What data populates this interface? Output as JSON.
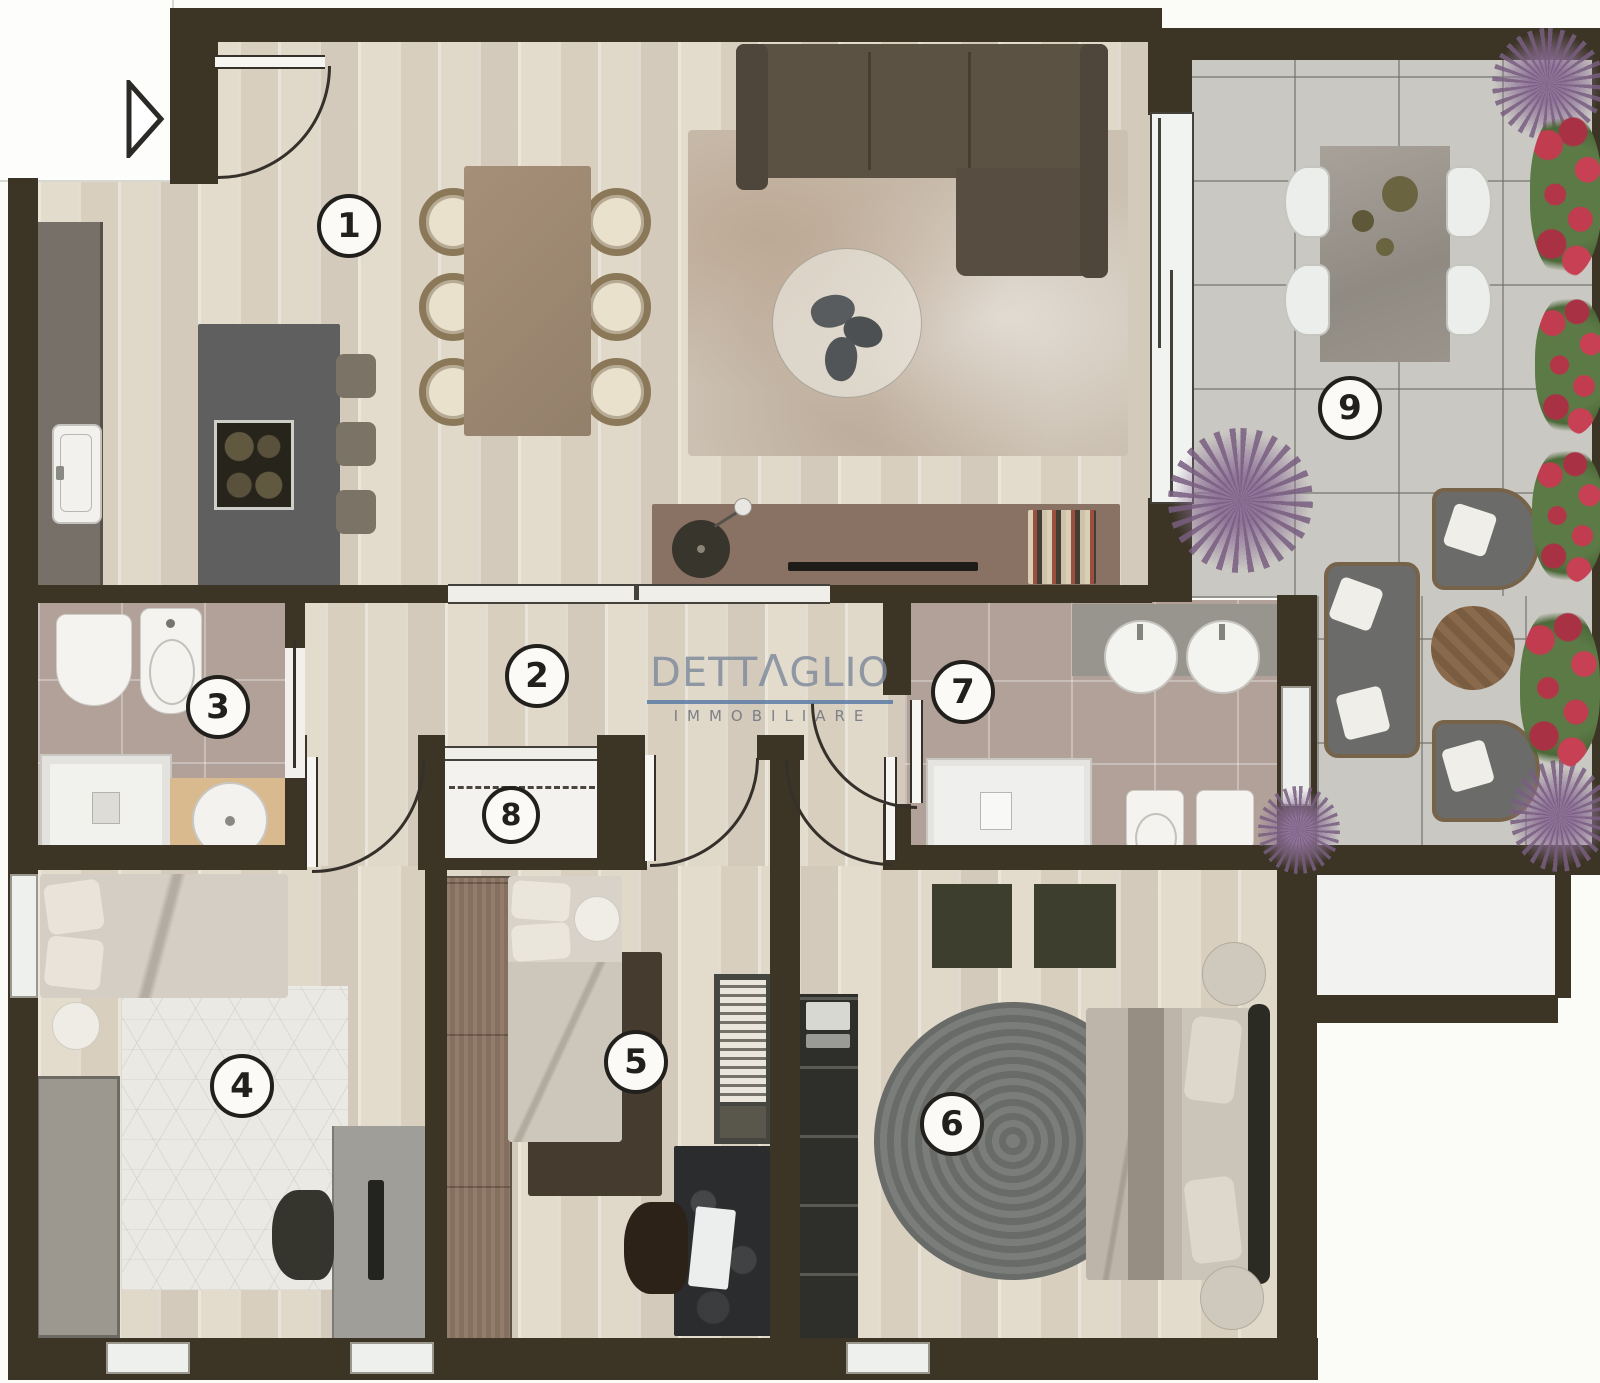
{
  "brand": {
    "word_start": "DETT",
    "word_a": "Λ",
    "word_end": "GLIO",
    "tagline": "IMMOBILIARE"
  },
  "rooms": {
    "living_kitchen": {
      "number": "1"
    },
    "hallway": {
      "number": "2"
    },
    "bathroom_2": {
      "number": "3"
    },
    "bedroom_1": {
      "number": "4"
    },
    "bedroom_2": {
      "number": "5"
    },
    "bedroom_master": {
      "number": "6"
    },
    "bathroom_1": {
      "number": "7"
    },
    "closet": {
      "number": "8"
    },
    "terrace": {
      "number": "9"
    }
  },
  "colors": {
    "wall": "#3c3526",
    "wood_floor": "#ddd5c6",
    "bath_tile": "#b1a199",
    "terrace_tile": "#cac8c3",
    "logo_text": "#818c9d",
    "logo_underline": "#5c7ba4"
  }
}
